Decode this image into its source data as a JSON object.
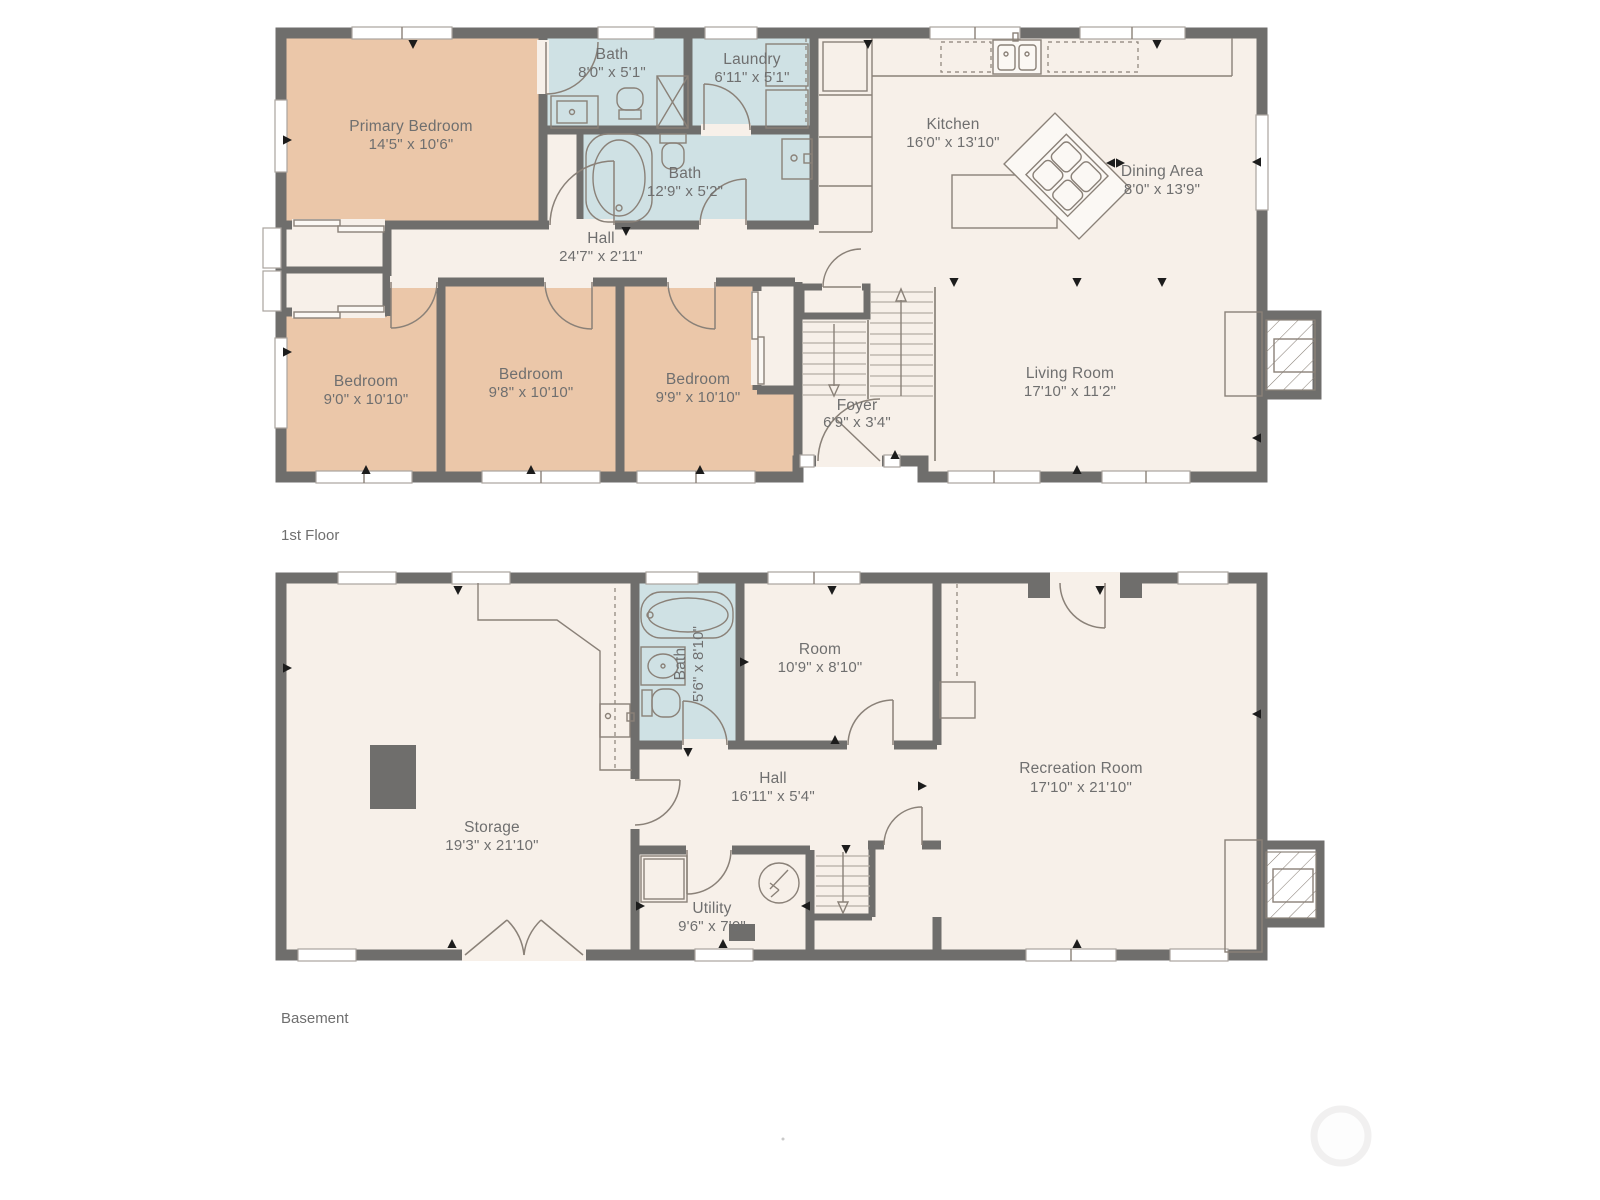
{
  "colors": {
    "wall": "#6F6E6C",
    "floor": "#F7F0E9",
    "bedroom": "#EBC7A9",
    "bath": "#CFE1E4",
    "label": "#6F6F6F",
    "fixture_line": "#8A8178"
  },
  "floors": [
    {
      "title": "1st Floor",
      "rooms": [
        {
          "name": "Primary Bedroom",
          "dims": "14'5\" x 10'6\""
        },
        {
          "name": "Bath",
          "dims": "8'0\" x 5'1\""
        },
        {
          "name": "Laundry",
          "dims": "6'11\" x 5'1\""
        },
        {
          "name": "Bath",
          "dims": "12'9\" x 5'2\""
        },
        {
          "name": "Kitchen",
          "dims": "16'0\" x 13'10\""
        },
        {
          "name": "Dining Area",
          "dims": "8'0\" x 13'9\""
        },
        {
          "name": "Hall",
          "dims": "24'7\" x 2'11\""
        },
        {
          "name": "Bedroom",
          "dims": "9'0\" x 10'10\""
        },
        {
          "name": "Bedroom",
          "dims": "9'8\" x 10'10\""
        },
        {
          "name": "Bedroom",
          "dims": "9'9\" x 10'10\""
        },
        {
          "name": "Foyer",
          "dims": "6'9\" x 3'4\""
        },
        {
          "name": "Living Room",
          "dims": "17'10\" x 11'2\""
        }
      ]
    },
    {
      "title": "Basement",
      "rooms": [
        {
          "name": "Bath",
          "dims": "5'6\" x 8'10\""
        },
        {
          "name": "Room",
          "dims": "10'9\" x 8'10\""
        },
        {
          "name": "Storage",
          "dims": "19'3\" x 21'10\""
        },
        {
          "name": "Hall",
          "dims": "16'11\" x 5'4\""
        },
        {
          "name": "Utility",
          "dims": "9'6\" x 7'0\""
        },
        {
          "name": "Recreation Room",
          "dims": "17'10\" x 21'10\""
        }
      ]
    }
  ]
}
